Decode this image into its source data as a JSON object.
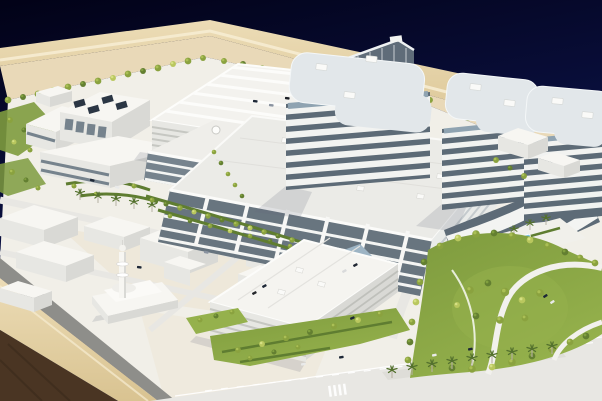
{
  "meta": {
    "description": "Photograph of a white architectural scale model of a large modern hospital campus, mounted on a light wooden presentation base with a dark brown wooden side, photographed against a dark navy-blue studio backdrop.",
    "width_px": 602,
    "height_px": 401
  },
  "labels": {
    "photo": "architectural scale model photograph",
    "backdrop": "dark blue studio backdrop",
    "base_rim": "light wooden base rim",
    "base_side": "dark wooden base side",
    "campus_ground": "white model ground plane",
    "sand_strip": "sand-coloured perimeter strip",
    "back_tree_row": "row of trees along rear boundary",
    "towers": "banded high-rise bed towers",
    "glass_tower": "dark glass tower",
    "podium": "main hospital podium building",
    "podium_wing": "terraced right wing",
    "north_parking": "north parking structure with rooftop parking",
    "south_parking": "south parking garage",
    "utility_plant": "central utility plant with rooftop chillers",
    "low_buildings": "low-rise support buildings",
    "mosque": "mosque with minaret",
    "context_blocks": "white context massing blocks",
    "park": "landscaped park with trees and curving roads",
    "boulevard": "main boulevard with palm tree median",
    "dropoff_pools": "entry drop-off with reflecting pools",
    "cars": "miniature model cars",
    "trees": "model trees",
    "palms": "model palm trees"
  },
  "colors": {
    "sky_top": "#020217",
    "sky_mid": "#0a1040",
    "sky_horizon": "#27397f",
    "wood_light": "#ecdcb6",
    "wood_mid": "#d9c391",
    "wood_dark": "#4a3523",
    "wood_edge_hi": "#f6ecd2",
    "curb": "#8e8e8a",
    "ground": "#f1efe8",
    "ground_warm": "#ece2cb",
    "sand": "#e9d9b8",
    "road": "#e8e7e3",
    "road_median": "#deddd8",
    "lane": "#ffffff",
    "bld_top": "#f7f6f2",
    "bld_face": "#e7e7e3",
    "bld_side": "#d9d9d5",
    "louver": "#c6c7c2",
    "glass_dark": "#68757f",
    "glass_panel": "#76838d",
    "glass_blue": "#9db4c4",
    "tower_core": "#5d6b77",
    "tower_band": "#f2f3f1",
    "tower_top": "#e2e7ea",
    "rtu": "#fafaf8",
    "green_light": "#b9c75e",
    "green_light_hi": "#d5e084",
    "green_mid": "#8aa23f",
    "green_mid_hi": "#aabf55",
    "green_dark": "#637f31",
    "green_dark_hi": "#81a03f",
    "lawn": "#7e9b3e",
    "lawn_light": "#95b14c",
    "hedge": "#5f7d31",
    "palm_frond": "#54712e",
    "palm_trunk": "#b5b0a2",
    "pool": "#7cc2e0",
    "car_dark": "#1d2736",
    "car_gray": "#8a93a0",
    "car_white": "#e9eaea",
    "shadow": "rgba(100,108,120,0.18)"
  }
}
